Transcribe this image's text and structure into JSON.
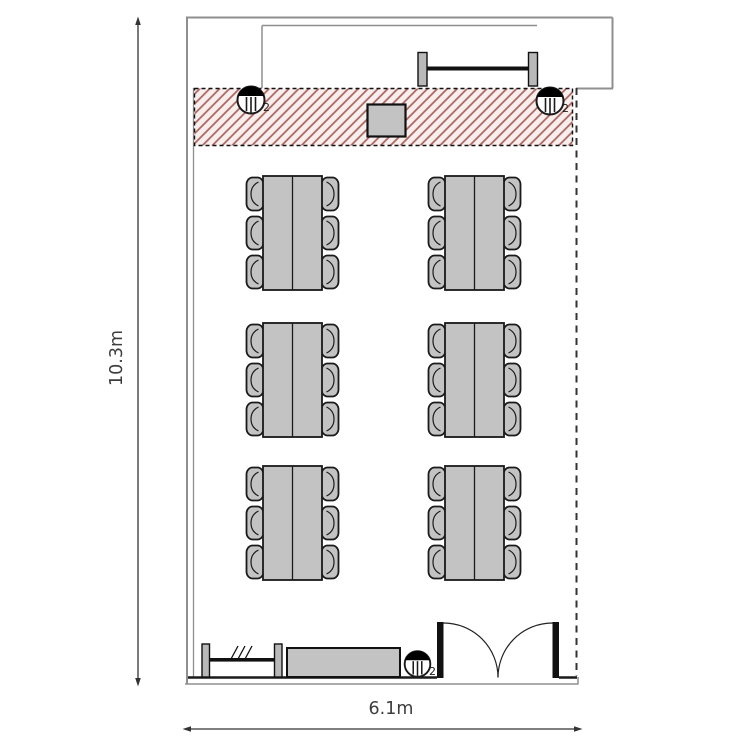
{
  "page": {
    "type": "room floor plan",
    "background": "#ffffff"
  },
  "dimensions": {
    "height_label": "10.3m",
    "width_label": "6.1m"
  },
  "room": {
    "zones": {
      "presentation_zone": "hatched strip along top wall"
    },
    "outlets": [
      {
        "name": "socket-top-left",
        "label": "2"
      },
      {
        "name": "socket-top-right",
        "label": "2"
      },
      {
        "name": "socket-bottom",
        "label": "2"
      }
    ],
    "furniture": {
      "table_group_count": 6,
      "chairs_per_group": 6,
      "total_chairs": 36,
      "fixtures": [
        "whiteboard",
        "projector-stand",
        "sideboard",
        "radiator",
        "double-door"
      ]
    },
    "colors": {
      "furniture_fill": "#c3c3c3",
      "bracket_fill": "#b9b9b9",
      "wall_gray": "#8f8f8f",
      "line_black": "#1a1a1a",
      "hatch_stroke": "#a8625b",
      "hatch_background": "#f8eeed",
      "dimension_text": "#3d3d3d"
    }
  }
}
